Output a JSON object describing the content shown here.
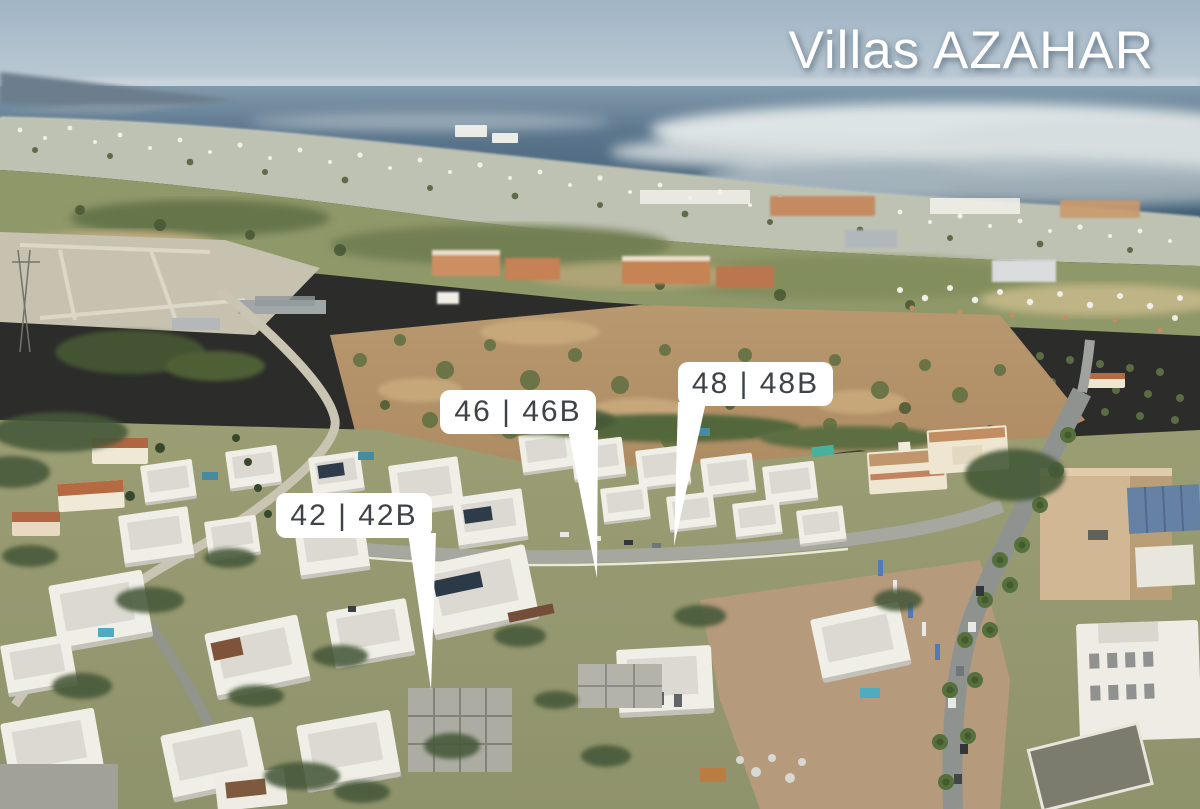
{
  "title": "Villas AZAHAR",
  "plot_labels": [
    {
      "id": "42-42b",
      "text": "42 | 42B"
    },
    {
      "id": "46-46b",
      "text": "46 | 46B"
    },
    {
      "id": "48-48b",
      "text": "48 | 48B"
    }
  ],
  "colors": {
    "title_color": "#ffffff",
    "label_bg": "#ffffff",
    "label_text": "#3f4347",
    "sky_top": "#9db2c6",
    "sky_bottom": "#cbd6de",
    "sea_deep": "#33536f",
    "sea_light": "#7c96ab",
    "fog": "#dde4e8",
    "town_band": "#bcc0b2",
    "field_green": "#8a9464",
    "scrub_tan": "#b08a5e",
    "villa_white": "#f0efe9",
    "roof_grey": "#dbd9d2",
    "road_grey": "#a3a49c",
    "pool_blue": "#3f86a0",
    "terracotta": "#b4643c",
    "vegetation_dark": "#3d5130"
  }
}
